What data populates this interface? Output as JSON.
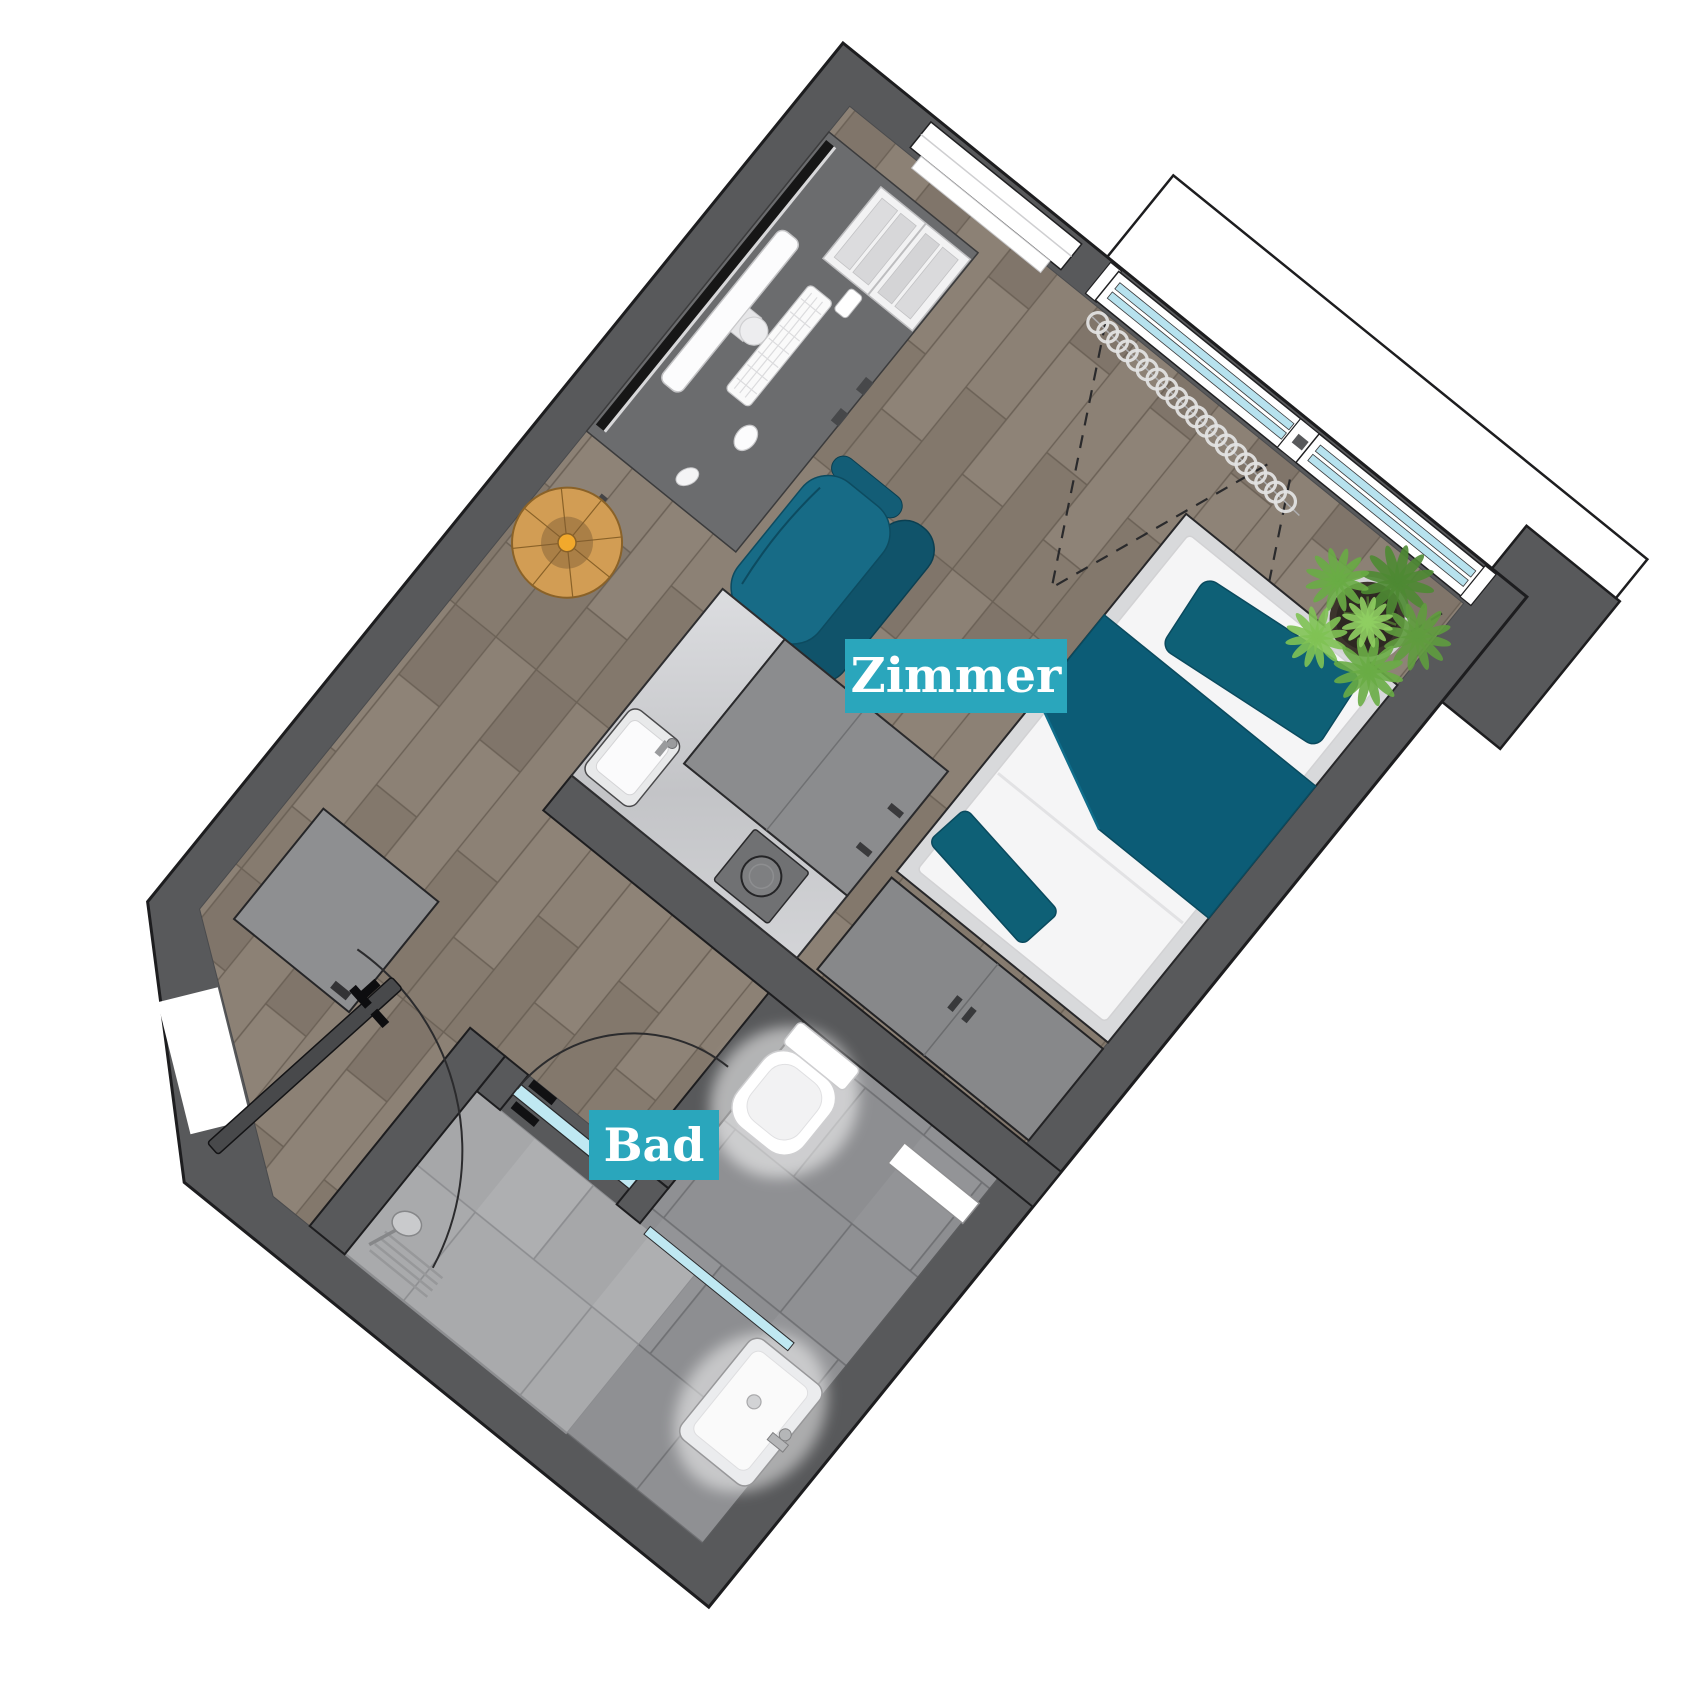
{
  "page": {
    "background": "#ffffff",
    "kind": "apartment floor plan"
  },
  "plan": {
    "rotation_deg": 39,
    "labels": {
      "zimmer": "Zimmer",
      "bad": "Bad"
    },
    "palette": {
      "label_bg": "#2aa6bc",
      "label_text": "#ffffff",
      "wall": "#58595b",
      "wall_outline": "#1d1d1f",
      "wood_floor": "#8a7f73",
      "tile_floor": "#909194",
      "tile_light": "#aaabad",
      "furniture_teal": "#0e6076",
      "chair_teal": "#176b86",
      "glass_blue": "#b7e2ee",
      "plant_green": "#5f9c3e",
      "table_wood": "#d29d54",
      "cabinet_gray": "#8b8c8e",
      "marble": "#d5d6d8"
    },
    "rooms": [
      {
        "id": "zimmer",
        "label": "Zimmer",
        "floor": "wood"
      },
      {
        "id": "bad",
        "label": "Bad",
        "floor": "tile"
      }
    ],
    "furniture": [
      "desk",
      "monitor",
      "keyboard",
      "mouse",
      "open-book",
      "desk-chair",
      "round-side-table",
      "bed",
      "pillow",
      "duvet",
      "foot-throw",
      "wardrobe",
      "kitchenette-counter",
      "kitchen-sink",
      "stove",
      "tall-cabinet",
      "potted-plant",
      "entry-cabinet",
      "toilet",
      "wall-shelf",
      "washbasin",
      "shower",
      "shower-glass",
      "curtain",
      "balcony",
      "entrance-door",
      "bathroom-door"
    ]
  }
}
